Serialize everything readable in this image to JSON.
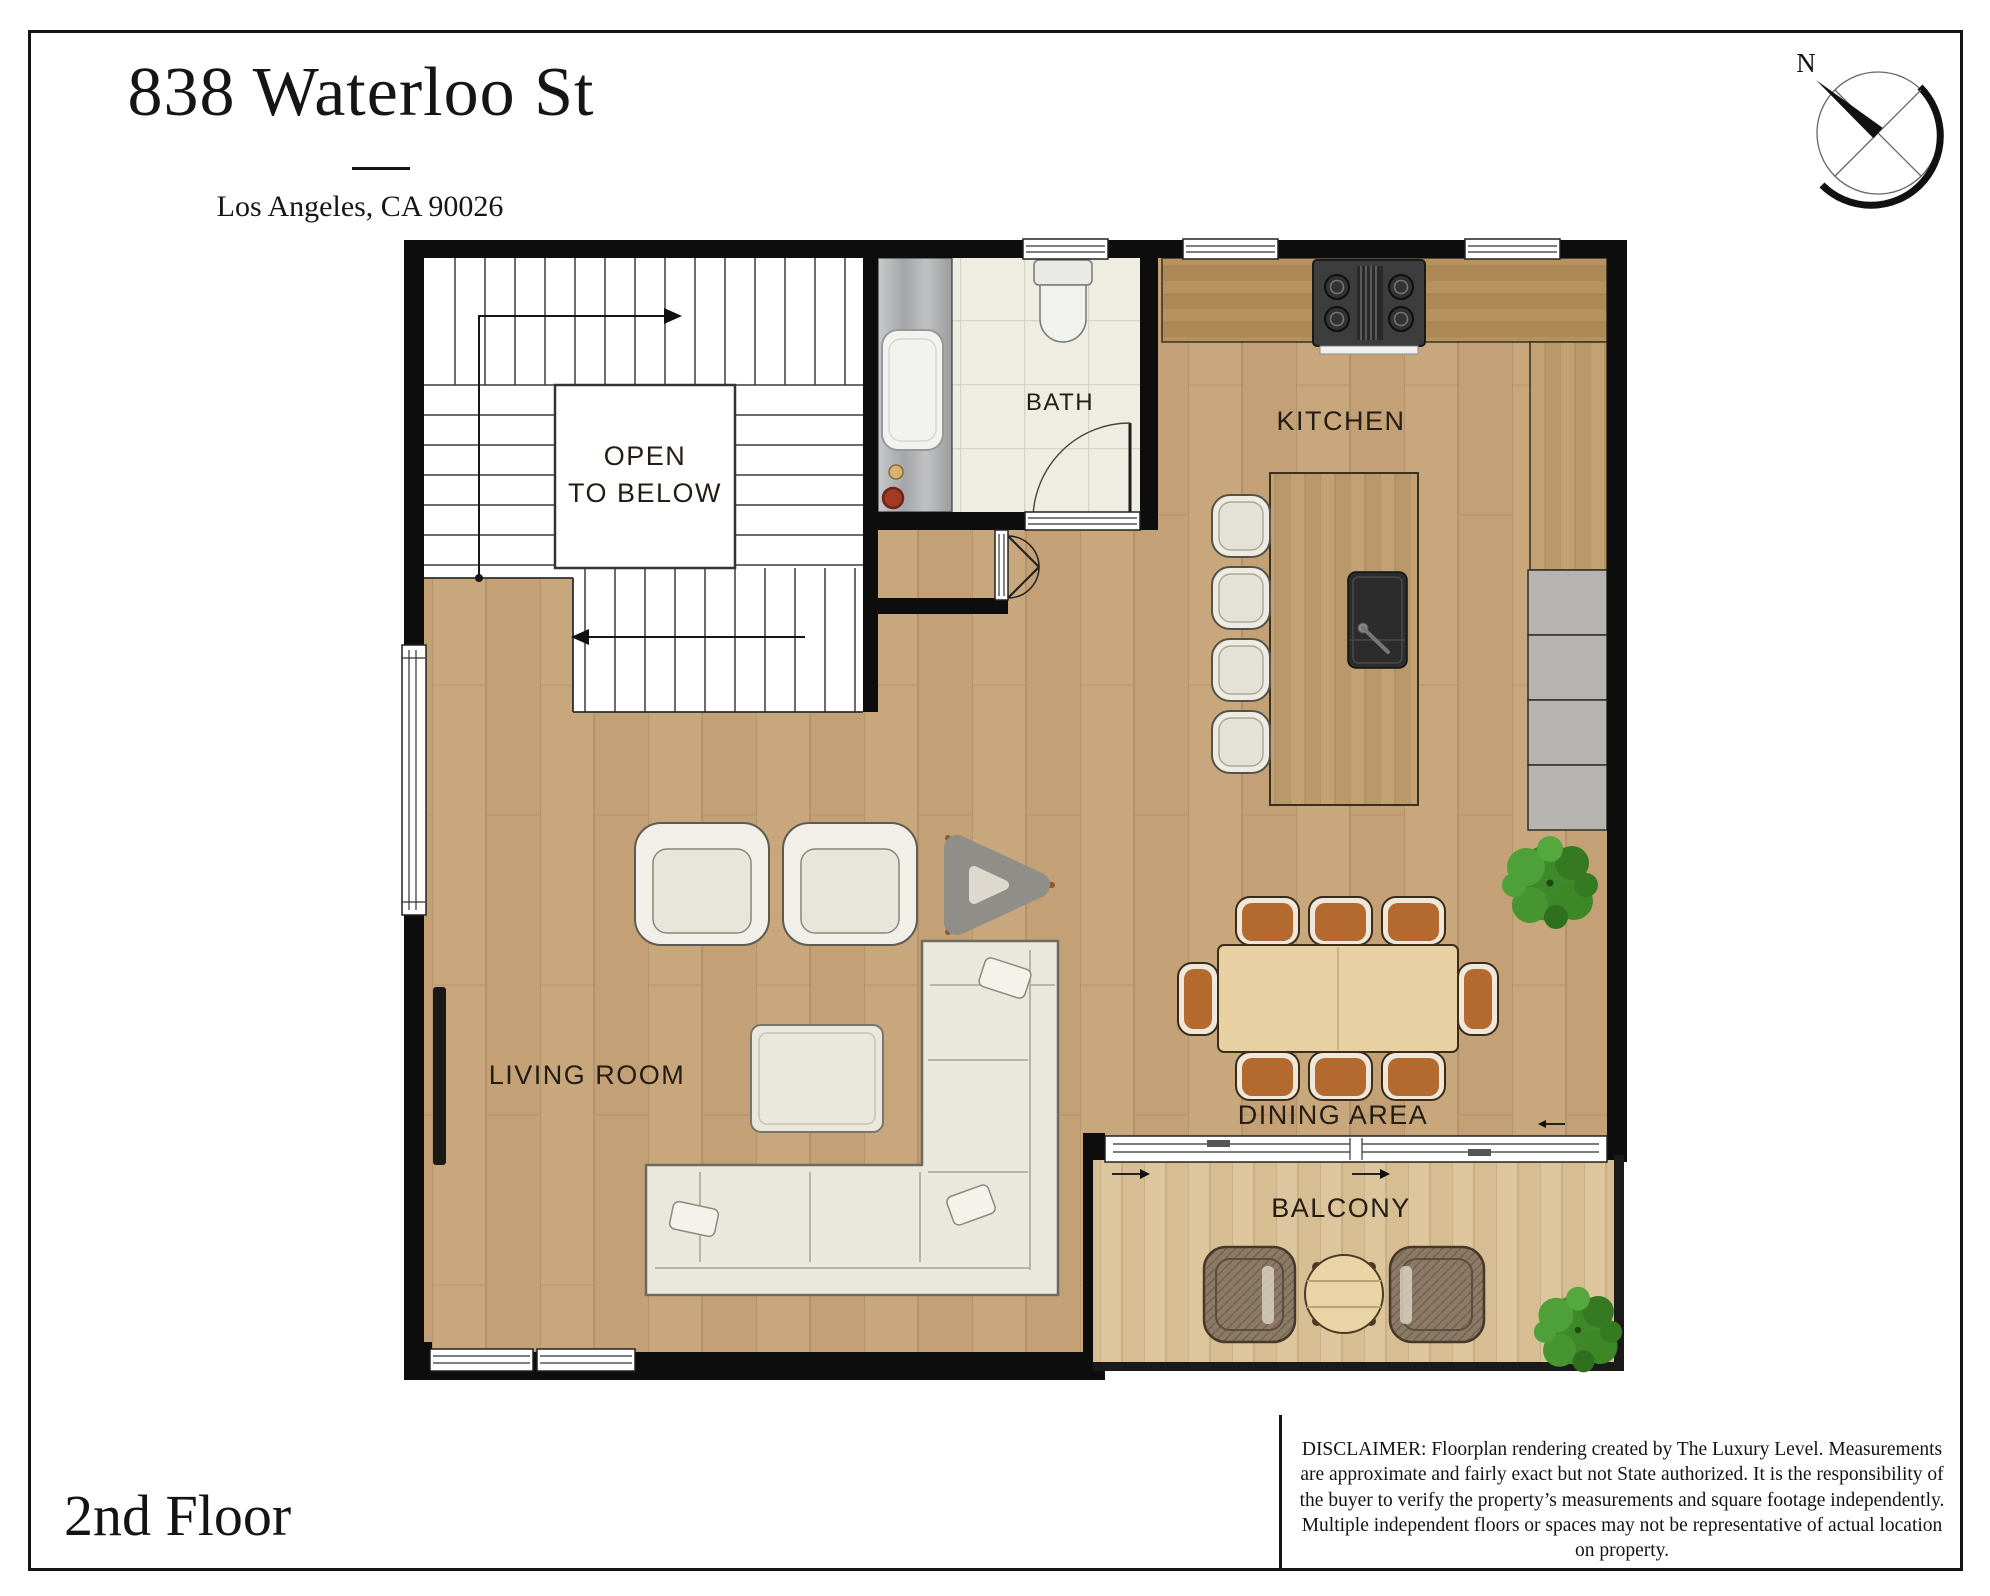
{
  "header": {
    "title": "838 Waterloo St",
    "subtitle": "Los Angeles, CA 90026"
  },
  "compass": {
    "north_label": "N"
  },
  "plan": {
    "rooms": {
      "open_to_below_line1": "OPEN",
      "open_to_below_line2": "TO BELOW",
      "bath": "BATH",
      "kitchen": "KITCHEN",
      "living_room": "LIVING ROOM",
      "dining_area": "DINING AREA",
      "balcony": "BALCONY"
    },
    "features": [
      "staircase",
      "bath-vanity-sink",
      "toilet",
      "stove-cooktop",
      "kitchen-island-sink",
      "bar-stools-x4",
      "dining-table-8-chairs",
      "sectional-sofa",
      "ottoman",
      "armchairs-x2",
      "side-table",
      "tv",
      "wicker-chairs-x2",
      "round-table",
      "plants-x2"
    ]
  },
  "footer": {
    "floor_label": "2nd Floor",
    "disclaimer": "DISCLAIMER: Floorplan rendering created by The Luxury Level. Measurements are approximate and fairly exact but not State authorized. It is the responsibility of the buyer to verify the property’s measurements and square footage independently. Multiple independent floors or spaces may not be representative of actual location on property."
  },
  "colors": {
    "wall": "#0d0d0d",
    "floor_wood": "#c8a77c",
    "deck_wood": "#ddc69e",
    "counter_wood": "#b5925f",
    "island_wood": "#c2a173",
    "tile": "#efece2",
    "vanity_marble": "#b0b1b3",
    "dining_chair_leather": "#b4692e",
    "plant_green": "#3e8a2b",
    "sofa_cream": "#eae7dc",
    "wicker_brown": "#8d7a66",
    "concrete_counter": "#b5b4b0"
  }
}
